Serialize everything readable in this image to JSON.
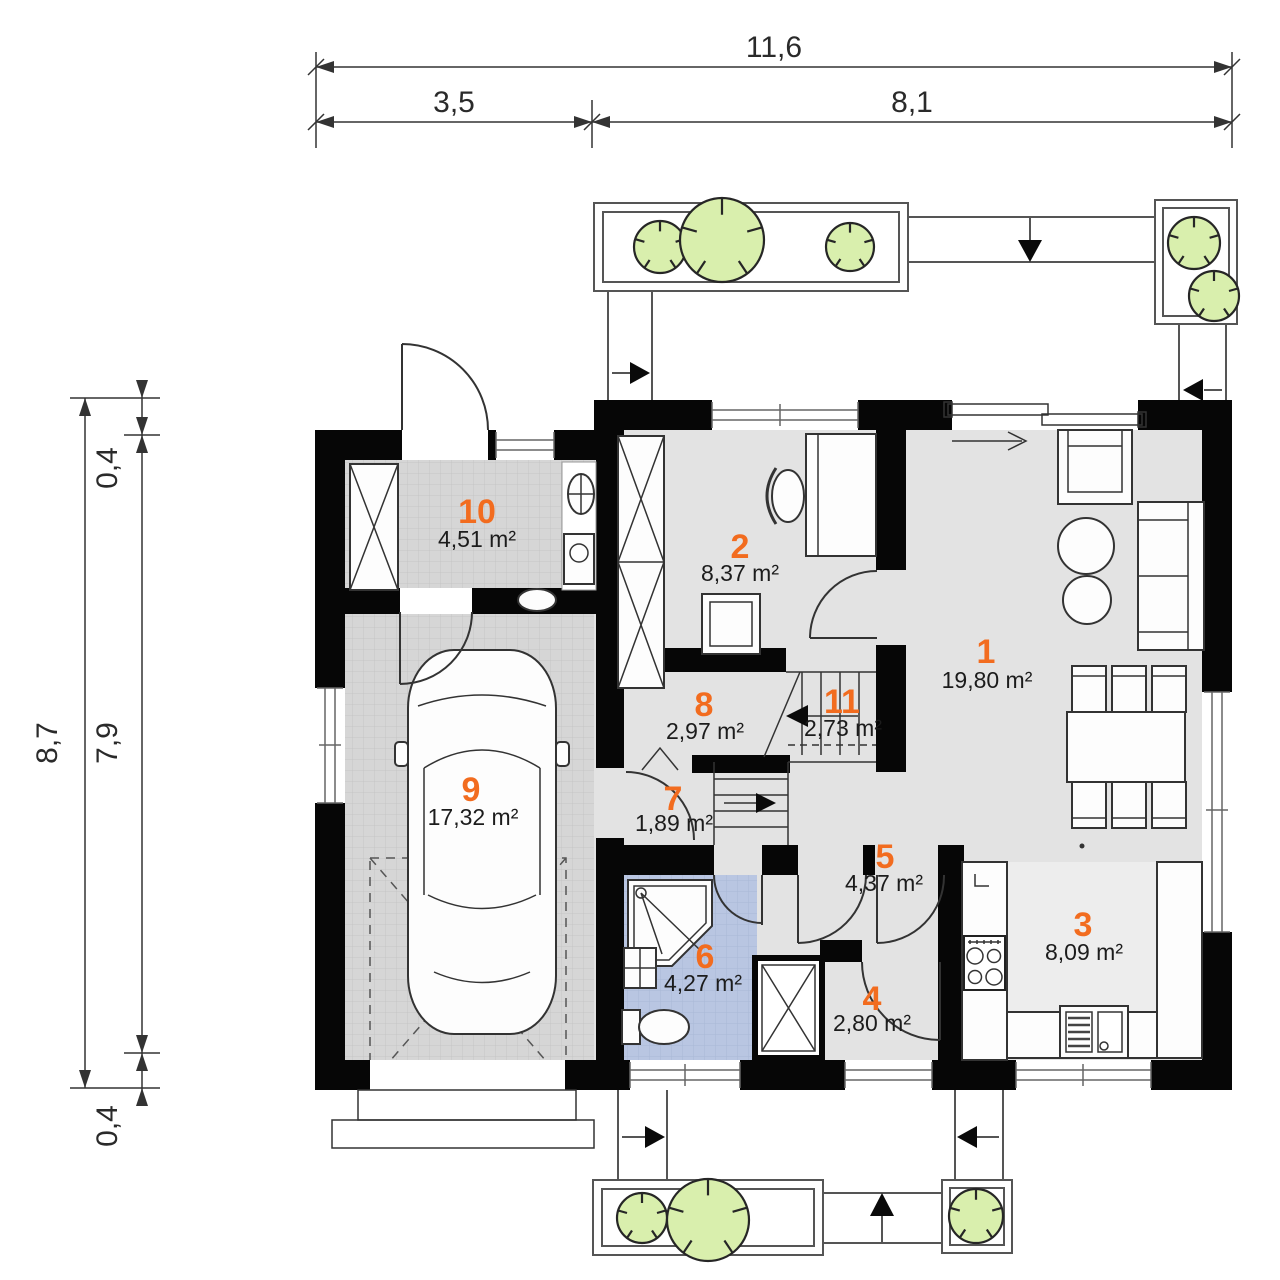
{
  "dimensions": {
    "total_width": "11,6",
    "garage_width": "3,5",
    "house_width": "8,1",
    "total_height": "8,7",
    "wall_top": "0,4",
    "inner_height": "7,9",
    "wall_bottom": "0,4"
  },
  "rooms": [
    {
      "number": "1",
      "area": "19,80 m²"
    },
    {
      "number": "2",
      "area": "8,37 m²"
    },
    {
      "number": "3",
      "area": "8,09 m²"
    },
    {
      "number": "4",
      "area": "2,80 m²"
    },
    {
      "number": "5",
      "area": "4,37 m²"
    },
    {
      "number": "6",
      "area": "4,27 m²"
    },
    {
      "number": "7",
      "area": "1,89 m²"
    },
    {
      "number": "8",
      "area": "2,97 m²"
    },
    {
      "number": "9",
      "area": "17,32 m²"
    },
    {
      "number": "10",
      "area": "4,51 m²"
    },
    {
      "number": "11",
      "area": "2,73 m²"
    }
  ],
  "colors": {
    "room_number": "#f26c1f",
    "area_text": "#1c1c1c",
    "wall": "#060606",
    "floor": "#e3e3e3",
    "tile_floor": "#d6d6d6",
    "bath_floor": "#b9c6e2",
    "vegetation": "#d9efad"
  }
}
